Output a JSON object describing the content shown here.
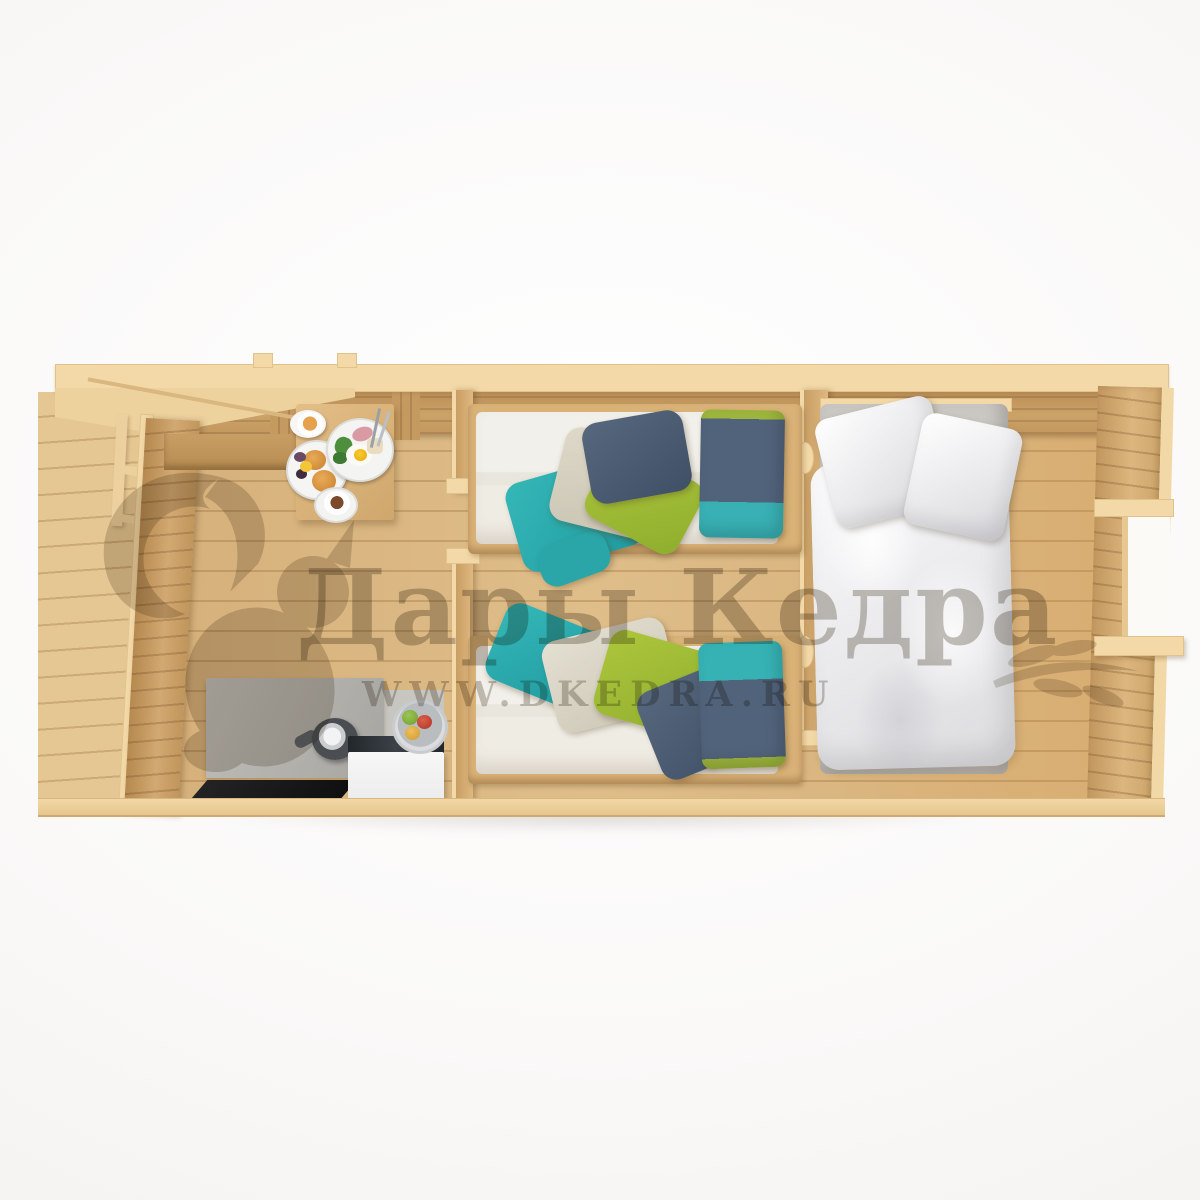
{
  "image": {
    "description": "Top-down cut-away 3D render of a wooden log cabin interior with left porch, kitchen-dining room, twin bedroom and double bedroom",
    "style": "product-render on white background"
  },
  "watermark": {
    "brand": "Дары Кедра",
    "website": "WWW.DKEDRA.RU",
    "color": "#6e6254",
    "logo": "squirrel-silhouette",
    "flourish": "leaf-branch"
  },
  "palette": {
    "background": "#f8f7f6",
    "floor_wood": "#d6b079",
    "wall_wood": "#c89e64",
    "cut_timber_cream": "#f3d9a7",
    "counter_gray": "#b5b3ae",
    "hob_black": "#151515",
    "cabinet_white": "#f4f4f4",
    "mattress_white": "#efece4",
    "blanket_teal": "#35b7b7",
    "blanket_green": "#a4c238",
    "blanket_slate": "#4b5e74",
    "blanket_beige": "#d9d4c4",
    "duvet_white": "#ededef"
  },
  "rooms": [
    {
      "name": "porch",
      "objects": [
        "deck-planks",
        "roof-overhang",
        "railing-post",
        "railing-bars"
      ]
    },
    {
      "name": "kitchen-dining",
      "objects": [
        "wall-bench",
        "dining-table",
        "breakfast-plates",
        "coffee-cup",
        "juice-glass",
        "gray-countertop",
        "kettle",
        "black-hob",
        "white-cabinet",
        "fruit-bowl-apples"
      ]
    },
    {
      "name": "twin-bedroom",
      "objects": [
        "single-bed-top",
        "single-bed-bottom",
        "teal-green-slate-blankets",
        "two-color-pillows"
      ]
    },
    {
      "name": "double-bedroom",
      "objects": [
        "double-bed",
        "white-duvet",
        "two-white-pillows",
        "window-in-right-wall"
      ]
    }
  ]
}
